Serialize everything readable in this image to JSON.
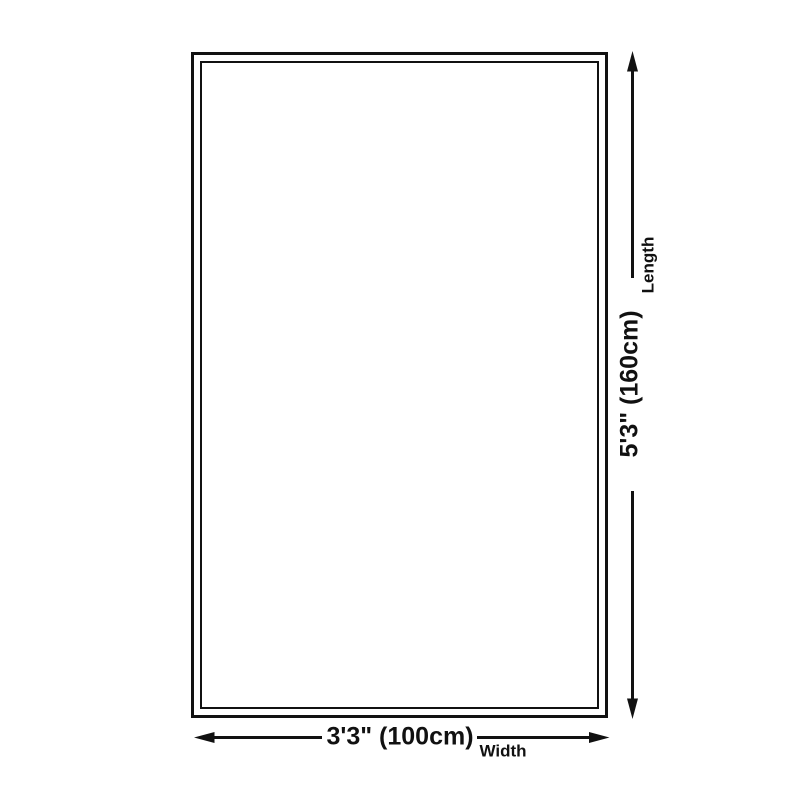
{
  "diagram": {
    "type": "product-dimension-diagram",
    "background_color": "#ffffff",
    "line_color": "#111111",
    "text_color": "#111111",
    "dimensions": {
      "width": {
        "value": "3'3\" (100cm)",
        "label": "Width"
      },
      "length": {
        "value": "5'3\" (160cm)",
        "label": "Length"
      }
    }
  }
}
